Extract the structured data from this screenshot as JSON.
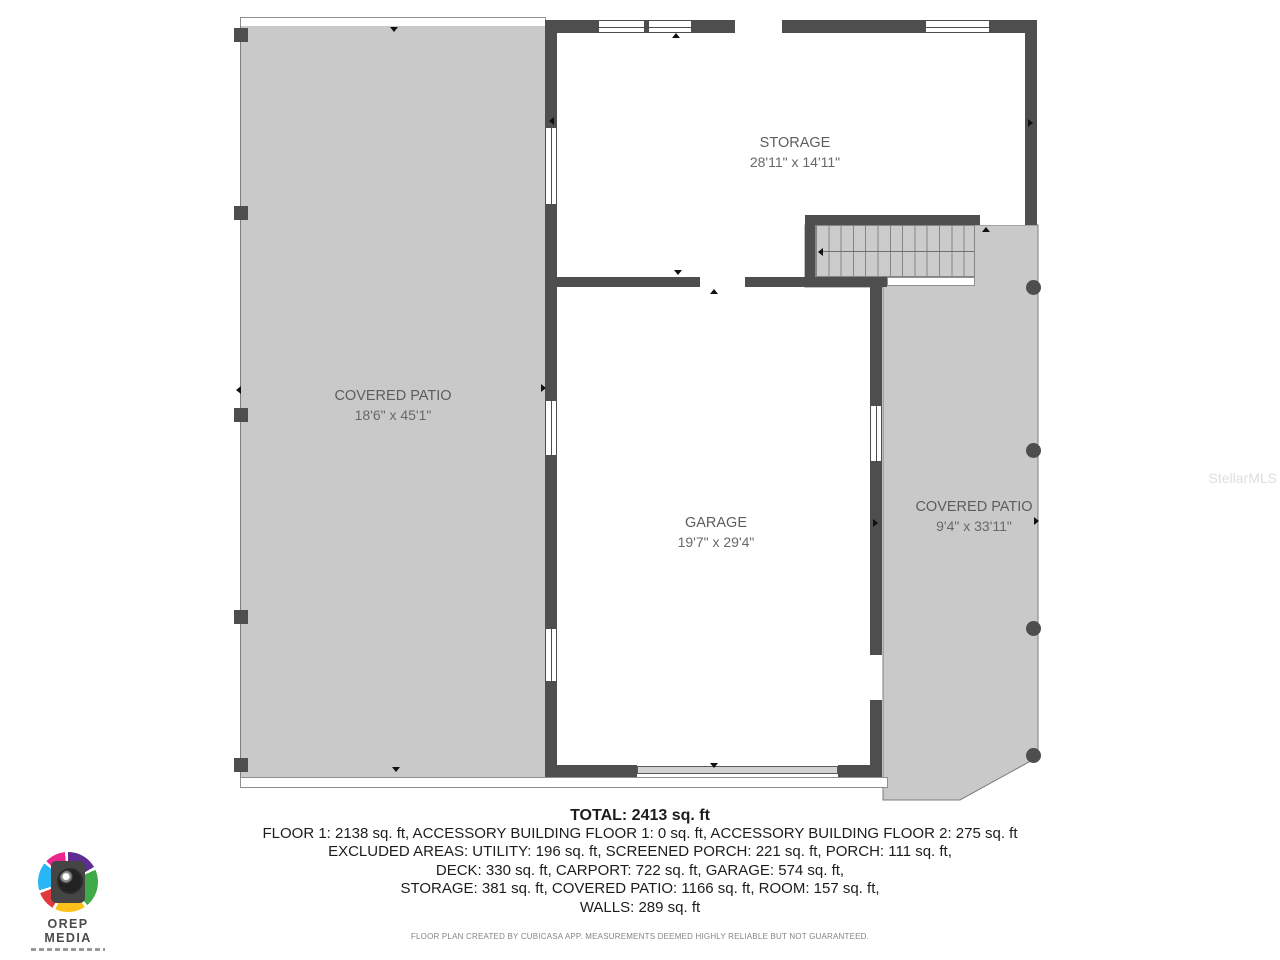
{
  "colors": {
    "wall": "#4e4e4e",
    "patio_fill": "#c9c9c9",
    "logo_pink": "#ec268f",
    "logo_purple": "#5e2d91",
    "logo_green": "#3faa47",
    "logo_yellow": "#fcc219",
    "logo_red": "#e03a3e",
    "logo_blue": "#29b6f6"
  },
  "floorplan": {
    "rooms": [
      {
        "id": "storage",
        "name": "STORAGE",
        "dimensions": "28'11\" x 14'11\""
      },
      {
        "id": "covered-patio-left",
        "name": "COVERED PATIO",
        "dimensions": "18'6\" x 45'1\""
      },
      {
        "id": "garage",
        "name": "GARAGE",
        "dimensions": "19'7\" x 29'4\""
      },
      {
        "id": "covered-patio-right",
        "name": "COVERED PATIO",
        "dimensions": "9'4\" x 33'11\""
      }
    ]
  },
  "summary": {
    "total": "TOTAL: 2413 sq. ft",
    "lines": [
      "FLOOR 1: 2138 sq. ft, ACCESSORY BUILDING FLOOR 1: 0 sq. ft, ACCESSORY BUILDING FLOOR 2: 275 sq. ft",
      "EXCLUDED AREAS: UTILITY: 196 sq. ft, SCREENED PORCH: 221 sq. ft, PORCH: 111 sq. ft,",
      "DECK: 330 sq. ft, CARPORT: 722 sq. ft, GARAGE: 574 sq. ft,",
      "STORAGE: 381 sq. ft, COVERED PATIO: 1166 sq. ft, ROOM: 157 sq. ft,",
      "WALLS: 289 sq. ft"
    ]
  },
  "disclaimer": "FLOOR PLAN CREATED BY CUBICASA APP. MEASUREMENTS DEEMED HIGHLY RELIABLE BUT NOT GUARANTEED.",
  "watermark": "StellarMLS",
  "logo": {
    "title": "OREP MEDIA"
  }
}
